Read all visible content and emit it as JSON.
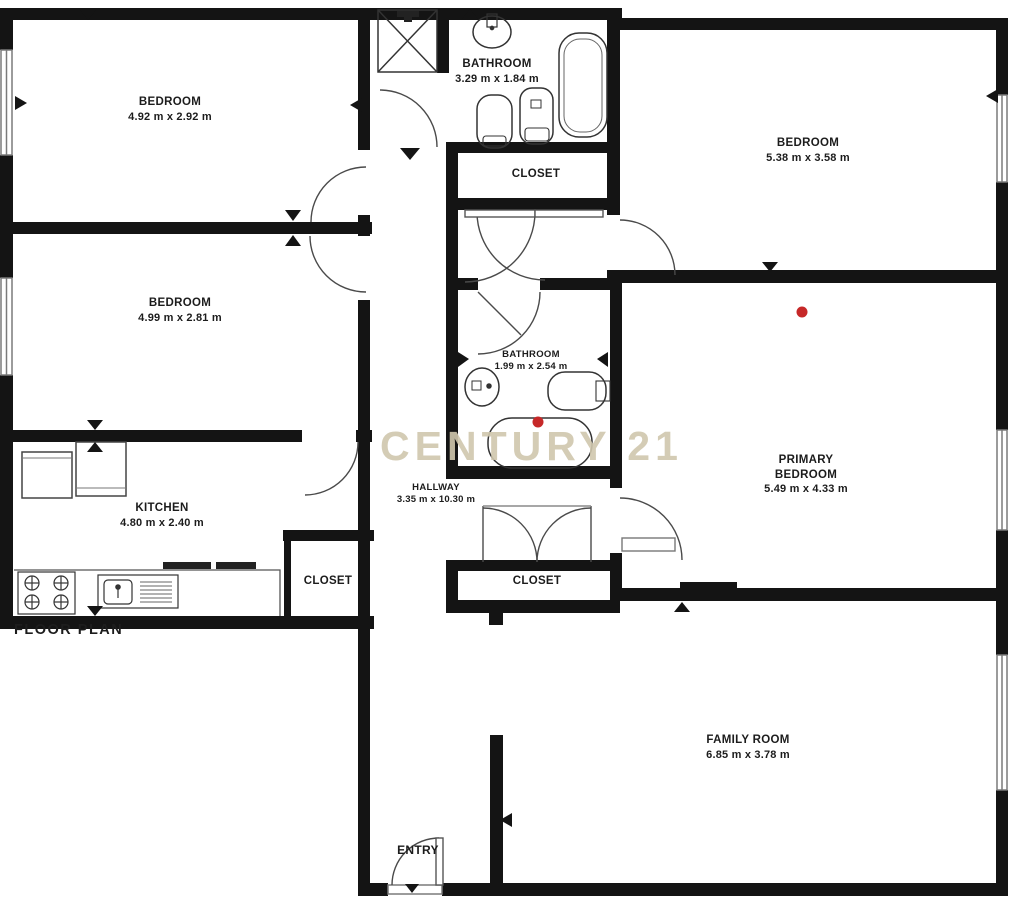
{
  "title": "FLOOR PLAN",
  "watermark": "CENTURY 21",
  "rooms": {
    "bedroom_top_left": {
      "name": "BEDROOM",
      "dims": "4.92 m x 2.92 m"
    },
    "bathroom_top": {
      "name": "BATHROOM",
      "dims": "3.29 m x 1.84 m"
    },
    "bedroom_top_right": {
      "name": "BEDROOM",
      "dims": "5.38 m x 3.58 m"
    },
    "closet_top": {
      "name": "CLOSET"
    },
    "bedroom_mid_left": {
      "name": "BEDROOM",
      "dims": "4.99 m x 2.81 m"
    },
    "bathroom_mid": {
      "name": "BATHROOM",
      "dims": "1.99 m x 2.54 m"
    },
    "primary_bedroom": {
      "name_line1": "PRIMARY",
      "name_line2": "BEDROOM",
      "dims": "5.49 m x 4.33 m"
    },
    "kitchen": {
      "name": "KITCHEN",
      "dims": "4.80 m x 2.40 m"
    },
    "closet_kitchen": {
      "name": "CLOSET"
    },
    "hallway": {
      "name": "HALLWAY",
      "dims": "3.35 m x 10.30 m"
    },
    "closet_hall": {
      "name": "CLOSET"
    },
    "family_room": {
      "name": "FAMILY ROOM",
      "dims": "6.85 m x 3.78 m"
    },
    "entry": {
      "name": "ENTRY"
    }
  },
  "colors": {
    "wall": "#141414",
    "line": "#3a3a3a",
    "marker_red": "#c62828",
    "watermark": "#d0c7ad"
  }
}
